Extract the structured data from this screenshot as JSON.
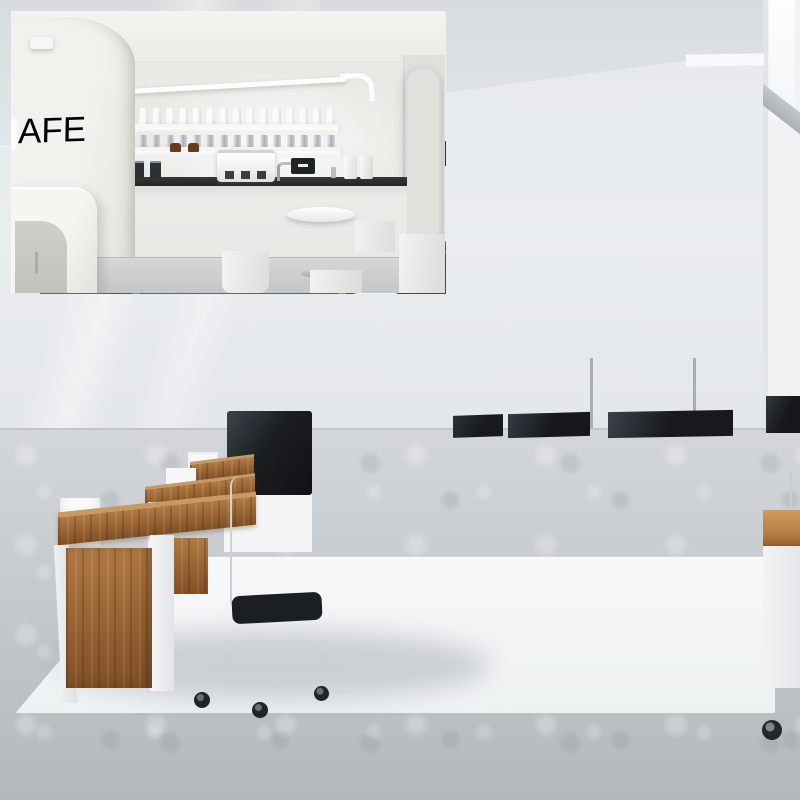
{
  "meta": {
    "title": "Round LED flush-mount ceiling light shown in three interiors (office, bedroom, cafe) photo collage",
    "visible_text_total": "AFE"
  },
  "office": {
    "label": "office workspace background scene",
    "ceiling_light_label": "round LED flush mount ceiling light",
    "palette": {
      "wall": "#e9ecee",
      "ceiling": "#dfe3e6",
      "floor": "#c6cacd",
      "mat": "#f3f5f6",
      "desk_wood": "#a06a38",
      "chair": "#222528",
      "monitor": "#1a1d20",
      "chrome": "#c3c8cc"
    },
    "desk_drawers_count": 3
  },
  "bedroom": {
    "label": "bedroom inset photo with two LED ceiling lights",
    "lights_count": 2,
    "palette": {
      "frame": "#ffffff",
      "ceiling": "#e9ebec",
      "wardrobe_wood": "#9c6b3e",
      "led_strip": "#ffab5e",
      "headboard": "#42474c",
      "pillow": "#f4f6f7",
      "duvet": "#6f8172",
      "rug": "#5c6b61",
      "floor": "#4a3c32",
      "armchair": "#3d4b41",
      "lamp": "#232629"
    }
  },
  "cafe": {
    "label": "cafe inset photo with two LED ceiling lights",
    "neon_text": "AFE",
    "lights_count": 2,
    "shelf_bags_count": 15,
    "shelf_cups_count": 15,
    "stools_count": 4,
    "palette": {
      "frame": "#ffffff",
      "wall": "#e9e9e5",
      "counter_top": "#2a2c2e",
      "cabinet": "#ebebe8",
      "espresso_machine": "#f6f7f5",
      "stool": "#eff0ee",
      "panel_dots": "#7d8287",
      "floor": "#cbcfcf"
    }
  }
}
